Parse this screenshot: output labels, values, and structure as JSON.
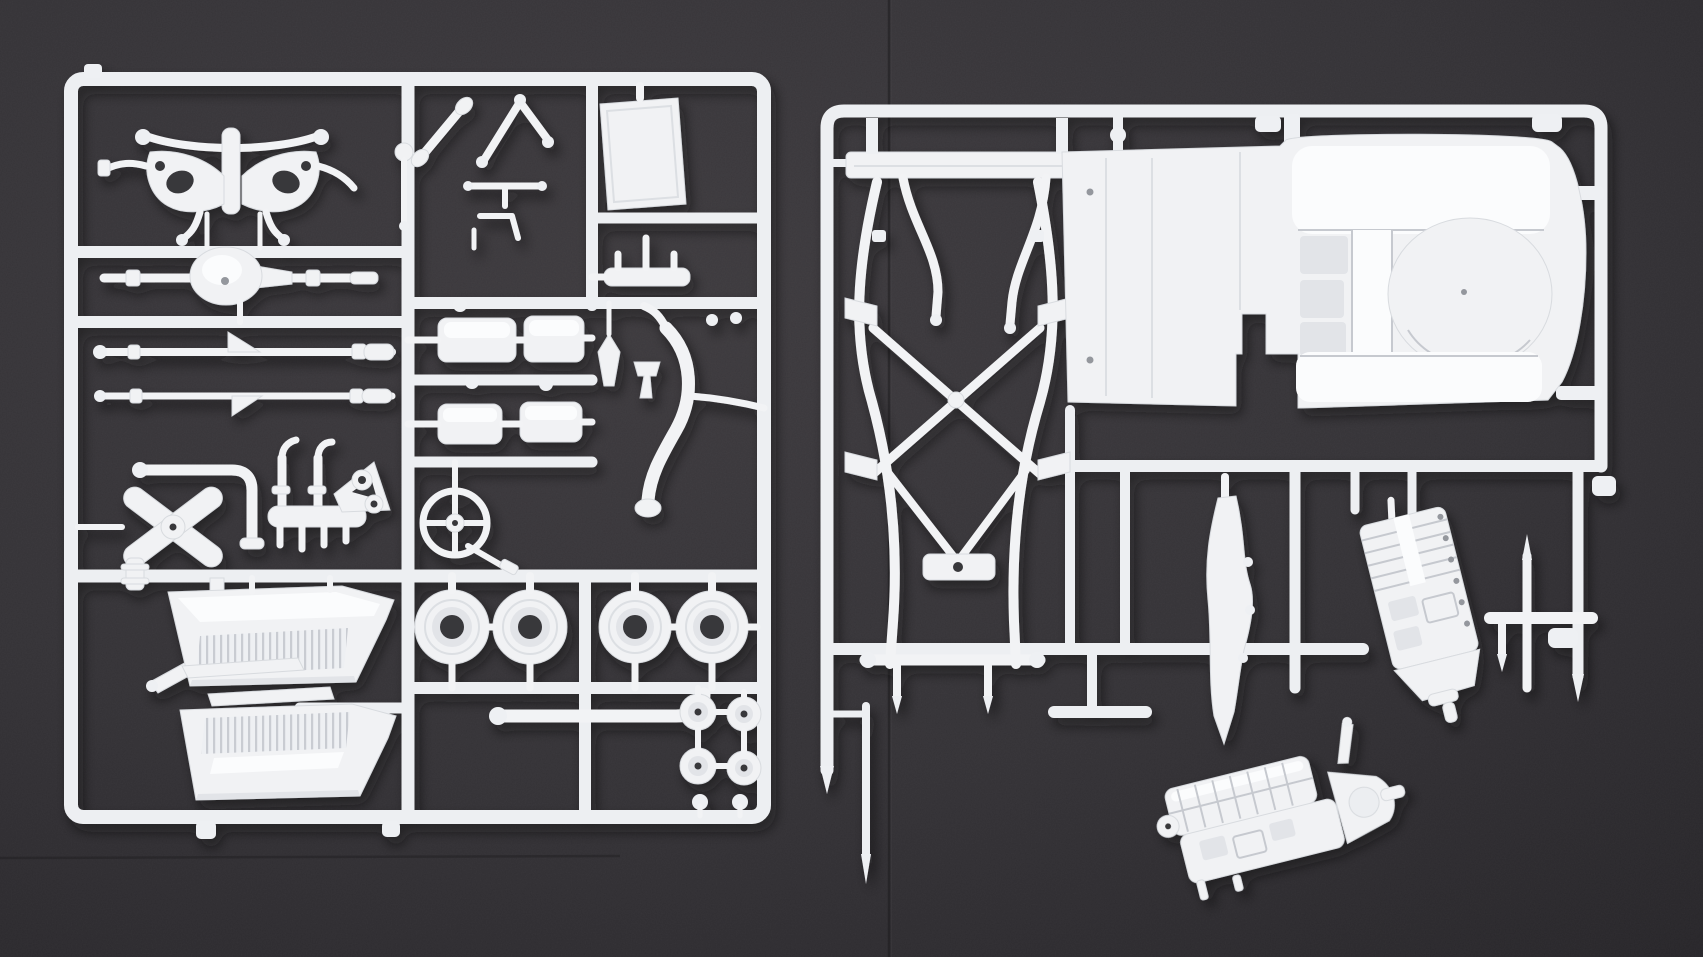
{
  "colors": {
    "background": "#343236",
    "background_inner": "#3e3b3f",
    "background_outer": "#252327",
    "seam": "#1b1a1c",
    "plastic": "#f1f2f4",
    "plastic_highlight": "#fbfcfd",
    "plastic_shade": "#dfe2e6",
    "plastic_deep_shade": "#c9ccd2",
    "hole": "#39373b",
    "cast_shadow": "#0b0b0c"
  },
  "scene": {
    "description": "Two white plastic model-car sprues and one loose engine part lying on a dark gray textured board",
    "background": {
      "surface": "dark textured board",
      "vertical_seam_x": 889,
      "horizontal_seam_y": 858
    },
    "sprues": [
      {
        "id": "left-sprue",
        "parts": [
          "front-axle-assembly",
          "rear-axle-with-differential",
          "driveshaft-rod",
          "tie-rod",
          "bent-exhaust-pipe",
          "exhaust-manifold",
          "shock-mount-bracket",
          "x-brace",
          "pipe-collar",
          "l-bracket",
          "angled-blade",
          "bench-seat-front",
          "bench-seat-rear",
          "seat-trim-strip-front",
          "seat-trim-strip-rear",
          "upper-wishbone",
          "lower-wishbone",
          "gear-lever",
          "steering-linkage",
          "leaf-spring-box-1",
          "leaf-spring-box-2",
          "leaf-spring-box-3",
          "leaf-spring-box-4",
          "steering-wheel",
          "steering-column",
          "cargo-floor-panel",
          "pegged-bar",
          "dart-bracket",
          "fork-bracket",
          "curved-exhaust-pipe",
          "brake-drum-1",
          "brake-drum-2",
          "brake-drum-3",
          "brake-drum-4",
          "j-shaped-pipe",
          "hub-cap-1",
          "hub-cap-2",
          "hub-cap-3",
          "hub-cap-4",
          "small-knob-1",
          "small-knob-2"
        ]
      },
      {
        "id": "right-sprue",
        "parts": [
          "spring-hanger-bar",
          "hanger-rod-left",
          "hanger-rod-right",
          "ladder-chassis-frame",
          "chassis-cross-plate",
          "floor-pan",
          "transmission-tunnel",
          "spare-tire-well-dome",
          "seat-bench-hump",
          "rocker-sill-strip",
          "engine-block-half",
          "mounting-bracket",
          "bayonet-rod",
          "pointed-runner-rod"
        ]
      },
      {
        "id": "loose-part",
        "parts": [
          "engine-and-gearbox-assembly"
        ]
      }
    ],
    "counts": {
      "sprues": 2,
      "loose_parts": 1,
      "brake_drums": 4,
      "bench_seats": 2,
      "leaf_spring_boxes": 4,
      "hub_caps": 4
    }
  }
}
